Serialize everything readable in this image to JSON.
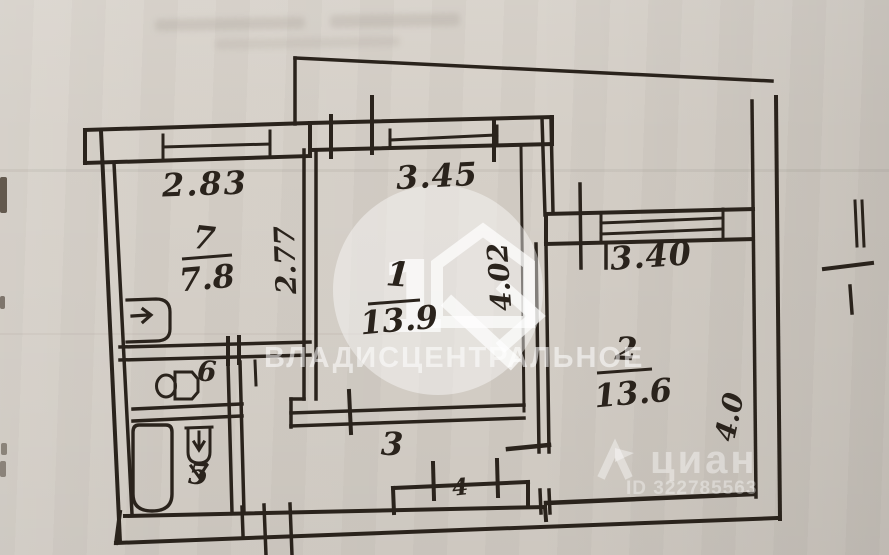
{
  "document_type": "apartment-floor-plan-scan",
  "rooms": {
    "r1": {
      "number": "1",
      "area": "13.9"
    },
    "r2": {
      "number": "2",
      "area": "13.6"
    },
    "r3": {
      "number": "3"
    },
    "r4": {
      "number": "4"
    },
    "r5": {
      "number": "5"
    },
    "r6": {
      "number": "6"
    },
    "r7": {
      "number": "7",
      "area": "7.8"
    }
  },
  "dimensions": {
    "r7_width": "2.83",
    "r7_depth": "2.77",
    "r1_width": "3.45",
    "r1_depth": "4.02",
    "r2_width": "3.40",
    "r2_depth": "4.0"
  },
  "watermarks": {
    "agency": {
      "logo_numeral": "1",
      "name": "ВЛАДИСЦЕНТРАЛЬНОЕ"
    },
    "cian": {
      "brand": "циан",
      "listing_id": "ID 322785563"
    }
  },
  "colors": {
    "paper": "#d5cfc7",
    "ink": "#2a231c",
    "watermark": "#ffffff"
  },
  "icons": [
    "bathtub-icon",
    "toilet-icon",
    "sink-icon",
    "stove-sink-icon",
    "house-logo-icon",
    "cian-pin-icon"
  ]
}
